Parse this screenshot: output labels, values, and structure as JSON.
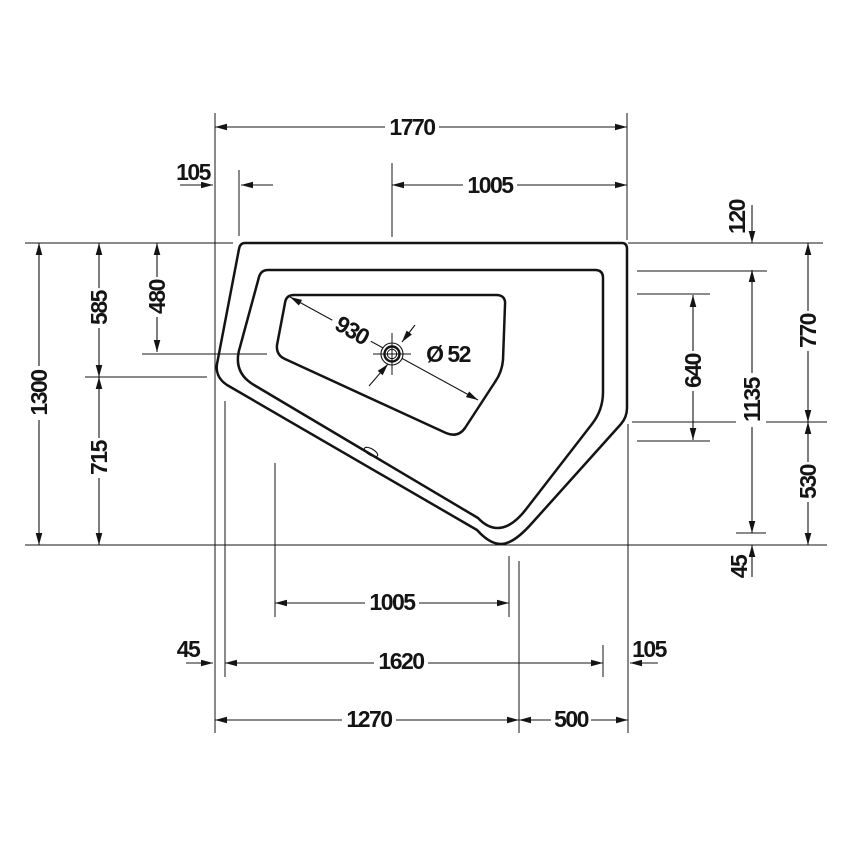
{
  "drawing": {
    "type": "technical-dimension-drawing",
    "subject": "corner bathtub top view",
    "colors": {
      "line": "#141414",
      "background": "#ffffff"
    }
  },
  "dims": {
    "top_total": "1770",
    "top_left": "105",
    "top_right": "1005",
    "rim_top_right": "120",
    "right_upper": "770",
    "right_mid": "1135",
    "basin_right": "640",
    "right_lower": "530",
    "right_bottom": "45",
    "left_total": "1300",
    "left_upper": "585",
    "drain_from_top": "480",
    "left_lower": "715",
    "basin_diagonal": "930",
    "drain_diameter": "Ø 52",
    "bottom_inner_span": "1005",
    "bottom_left": "45",
    "bottom_mid": "1620",
    "bottom_right": "105",
    "bottom_total_left": "1270",
    "bottom_total_right": "500"
  }
}
